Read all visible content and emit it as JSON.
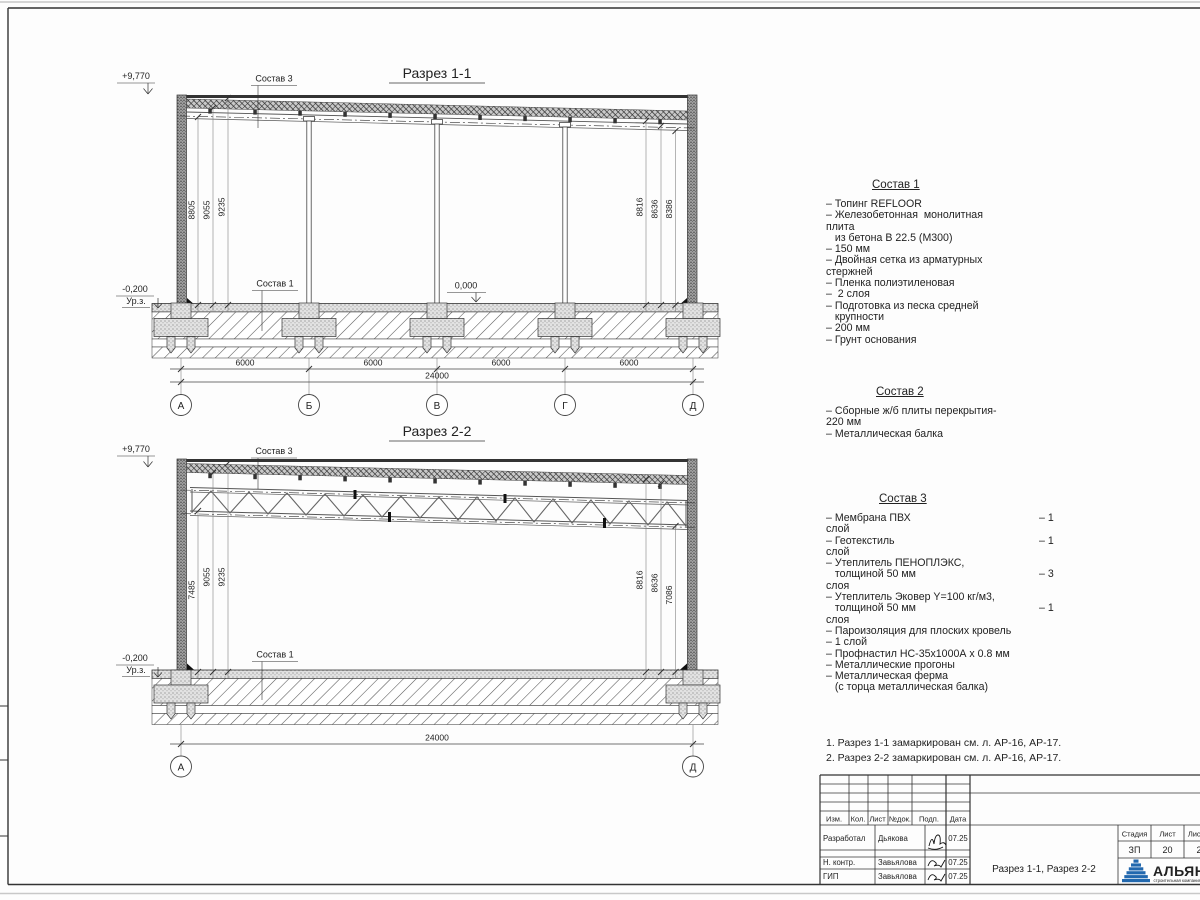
{
  "s1": {
    "title": "Разрез 1-1",
    "elev_top": "+9,770",
    "elev_zero": "0,000",
    "elev_minus": "-0,200",
    "urz": "Ур.з.",
    "sostav3": "Состав 3",
    "sostav1": "Состав 1",
    "dims_left": [
      "8805",
      "9055",
      "9235"
    ],
    "dims_right": [
      "8816",
      "8636",
      "8386"
    ],
    "spans": [
      "6000",
      "6000",
      "6000",
      "6000"
    ],
    "total": "24000",
    "axes": [
      "А",
      "Б",
      "В",
      "Г",
      "Д"
    ]
  },
  "s2": {
    "title": "Разрез 2-2",
    "elev_top": "+9,770",
    "elev_minus": "-0,200",
    "urz": "Ур.з.",
    "sostav3": "Состав 3",
    "sostav1": "Состав 1",
    "dims_left": [
      "7485",
      "9055",
      "9235"
    ],
    "dims_right": [
      "8816",
      "8636",
      "7086"
    ],
    "total": "24000",
    "axes": [
      "А",
      "Д"
    ]
  },
  "comps": [
    {
      "title": "Состав 1",
      "lines": [
        {
          "t": "– Топинг REFLOOR",
          "r": ""
        },
        {
          "t": "– Железобетонная  монолитная",
          "r": ""
        },
        {
          "t": "плита",
          "r": ""
        },
        {
          "t": "   из бетона В 22.5 (М300)",
          "r": ""
        },
        {
          "t": "– 150 мм",
          "r": ""
        },
        {
          "t": "– Двойная сетка из арматурных",
          "r": ""
        },
        {
          "t": "стержней",
          "r": ""
        },
        {
          "t": "– Пленка полиэтиленовая",
          "r": ""
        },
        {
          "t": "–  2 слоя",
          "r": ""
        },
        {
          "t": "– Подготовка из песка средней",
          "r": ""
        },
        {
          "t": "   крупности",
          "r": ""
        },
        {
          "t": "– 200 мм",
          "r": ""
        },
        {
          "t": "– Грунт основания",
          "r": ""
        }
      ]
    },
    {
      "title": "Состав 2",
      "lines": [
        {
          "t": "– Сборные ж/б плиты перекрытия-",
          "r": ""
        },
        {
          "t": "220 мм",
          "r": ""
        },
        {
          "t": "– Металлическая балка",
          "r": ""
        }
      ]
    },
    {
      "title": "Состав 3",
      "lines": [
        {
          "t": "– Мембрана ПВХ",
          "r": "– 1"
        },
        {
          "t": "слой",
          "r": ""
        },
        {
          "t": "– Геотекстиль",
          "r": "– 1"
        },
        {
          "t": "слой",
          "r": ""
        },
        {
          "t": "– Утеплитель ПЕНОПЛЭКС,",
          "r": ""
        },
        {
          "t": "   толщиной 50 мм",
          "r": "– 3"
        },
        {
          "t": "слоя",
          "r": ""
        },
        {
          "t": "– Утеплитель Эковер Y=100 кг/м3,",
          "r": ""
        },
        {
          "t": "   толщиной 50 мм",
          "r": "– 1"
        },
        {
          "t": "слоя",
          "r": ""
        },
        {
          "t": "– Пароизоляция для плоских кровель",
          "r": ""
        },
        {
          "t": "– 1 слой",
          "r": ""
        },
        {
          "t": "– Профнастил НС-35х1000А х 0.8 мм",
          "r": ""
        },
        {
          "t": "– Металлические прогоны",
          "r": ""
        },
        {
          "t": "– Металлическая ферма",
          "r": ""
        },
        {
          "t": "   (с торца металлическая балка)",
          "r": ""
        }
      ]
    }
  ],
  "notes": [
    "1. Разрез 1-1 замаркирован см. л. АР-16, АР-17.",
    "2. Разрез 2-2 замаркирован см. л. АР-16, АР-17."
  ],
  "tb": {
    "cols": [
      "Изм.",
      "Кол.",
      "Лист",
      "№док.",
      "Подп.",
      "Дата"
    ],
    "rows": [
      {
        "role": "Разработал",
        "name": "Дьякова",
        "date": "07.25"
      },
      {
        "role": "Н. контр.",
        "name": "Завьялова",
        "date": "07.25"
      },
      {
        "role": "ГИП",
        "name": "Завьялова",
        "date": "07.25"
      }
    ],
    "doc_title": "Разрез 1-1, Разрез 2-2",
    "stage_h": "Стадия",
    "sheet_h": "Лист",
    "sheets_h": "Листов",
    "stage": "ЗП",
    "sheet": "20",
    "sheets": "2",
    "logo": "АЛЬЯНС",
    "logo_sub": "строительная компания",
    "logo_color": "#2268ae"
  }
}
